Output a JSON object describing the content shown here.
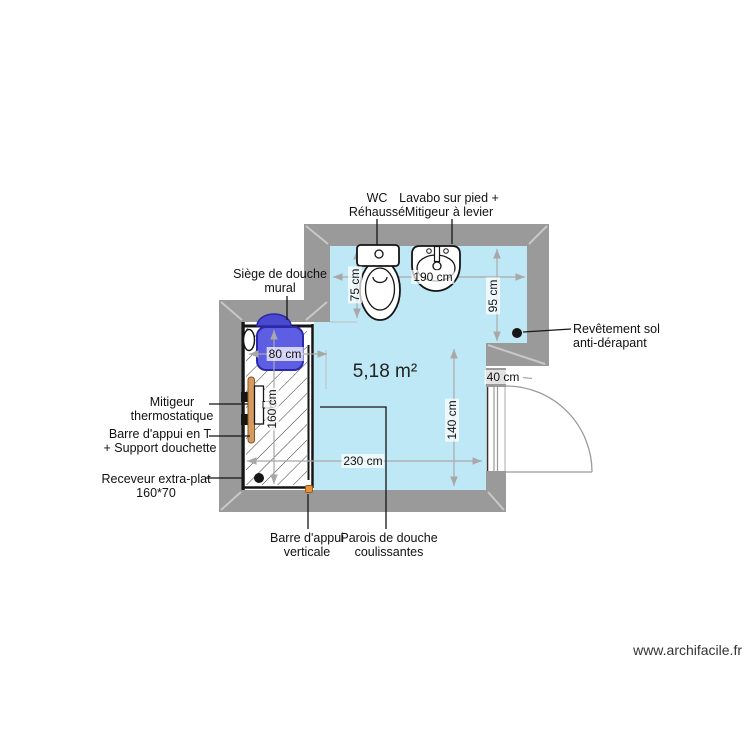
{
  "area": "5,18 m²",
  "watermark": "www.archifacile.fr",
  "labels": {
    "wc": "WC\nRéhaussé",
    "lavabo": "Lavabo sur pied +\nMitigeur à levier",
    "siege": "Siège de douche\nmural",
    "mitigeur": "Mitigeur\nthermostatique",
    "barre_t": "Barre d'appui en T\n+ Support douchette",
    "receveur": "Receveur extra-plat\n160*70",
    "revetement": "Revêtement sol\nanti-dérapant",
    "barre_verticale": "Barre d'appui\nverticale",
    "parois": "Parois de douche\ncoulissantes"
  },
  "dimensions": {
    "width_top": "190 cm",
    "right_upper": "95 cm",
    "wc_depth": "75 cm",
    "seat_width": "80 cm",
    "shower_length": "160 cm",
    "right_lower": "140 cm",
    "width_bottom": "230 cm",
    "door_wall": "40 cm"
  },
  "colors": {
    "wall_gray": "#9a9a9a",
    "corner_gray": "#c8c8c8",
    "floor_blue": "#bfe8f7",
    "seat_blue": "#5e5ee4",
    "seat_dome": "#4a4ad0",
    "seat_border": "#2a2aa8",
    "bar_tan": "#d49a62",
    "dot_orange": "#e8923a",
    "dim_gray": "#a8a8a8",
    "line_black": "#151515"
  }
}
